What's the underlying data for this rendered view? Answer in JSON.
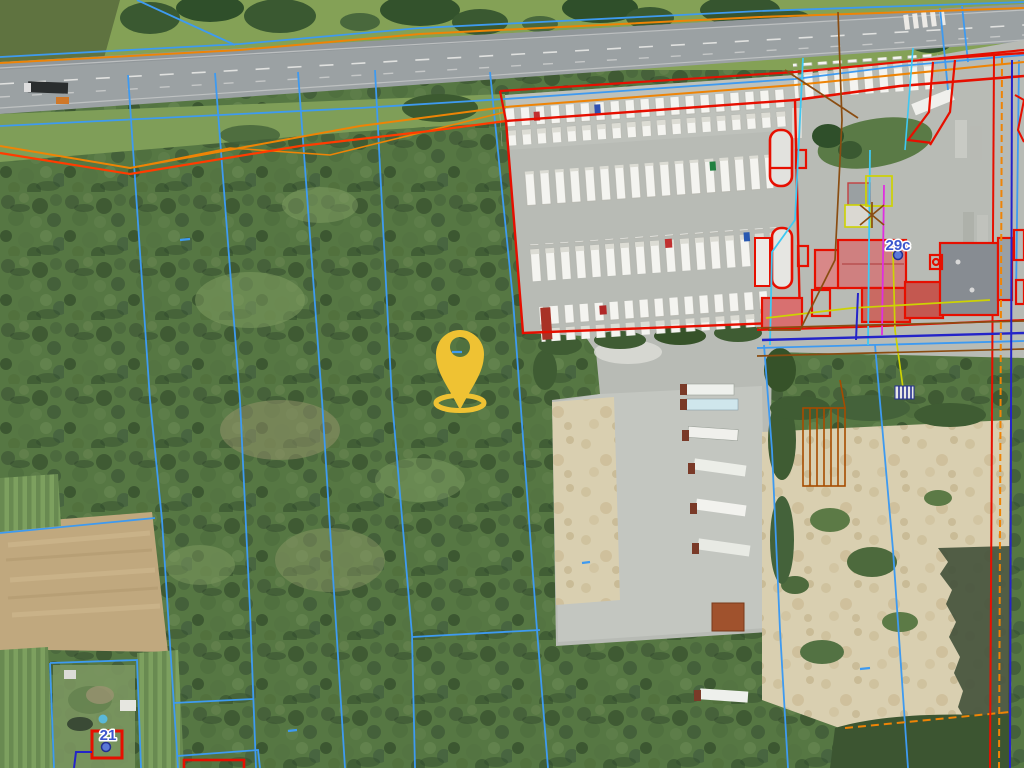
{
  "map": {
    "description": "Aerial orthophoto with cadastral parcel overlay, truck stop and forest parcels",
    "labels": {
      "parcel_29c": "29c",
      "parcel_21": "21"
    },
    "marker": {
      "name": "location-pin",
      "color": "#efc233"
    },
    "colors": {
      "parcel_boundary_blue": "#3e9af0",
      "building_outline_red": "#e60f00",
      "boundary_orange": "#ee8406",
      "boundary_red_orange": "#ff3c00",
      "utility_cyan": "#3fc8f2",
      "utility_magenta": "#df2fdf",
      "utility_yellow": "#cdd203",
      "utility_brown": "#8a4d12",
      "utility_dark_blue": "#2424c8",
      "label_text_blue": "#3c55cc"
    }
  }
}
